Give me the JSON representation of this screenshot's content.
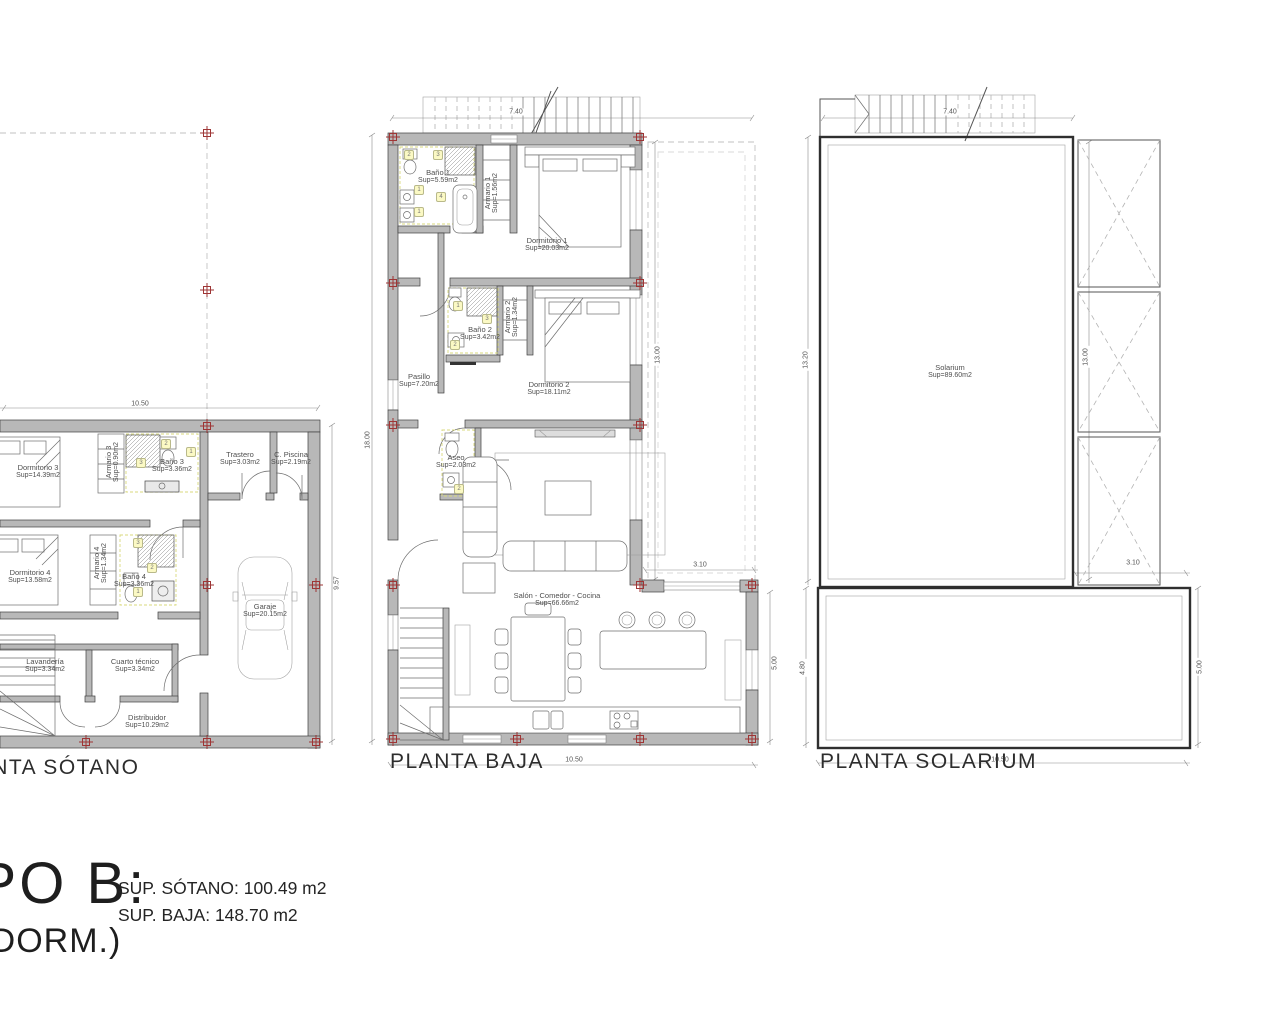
{
  "plans": {
    "sotano": {
      "title": "PLANTA SÓTANO",
      "rooms": {
        "dormitorio3": {
          "name": "Dormitorio 3",
          "area": "Sup=14.39m2"
        },
        "armario3": {
          "name": "Armario 3",
          "area": "Sup=0.90m2"
        },
        "bano3": {
          "name": "Baño 3",
          "area": "Sup=3.36m2"
        },
        "trastero": {
          "name": "Trastero",
          "area": "Sup=3.03m2"
        },
        "cpiscina": {
          "name": "C. Piscina",
          "area": "Sup=2.19m2"
        },
        "dormitorio4": {
          "name": "Dormitorio 4",
          "area": "Sup=13.58m2"
        },
        "armario4": {
          "name": "Armario 4",
          "area": "Sup=1.34m2"
        },
        "bano4": {
          "name": "Baño 4",
          "area": "Sup=3.36m2"
        },
        "garaje": {
          "name": "Garaje",
          "area": "Sup=20.15m2"
        },
        "lavanderia": {
          "name": "Lavandería",
          "area": "Sup=3.34m2"
        },
        "cuartotecnico": {
          "name": "Cuarto técnico",
          "area": "Sup=3.34m2"
        },
        "distribuidor": {
          "name": "Distribuidor",
          "area": "Sup=10.29m2"
        }
      },
      "dims": {
        "width_top": "10.50",
        "height_right": "9.57"
      },
      "badges": {
        "bano3": [
          "2",
          "1",
          "3"
        ],
        "bano4": [
          "3",
          "2",
          "1"
        ]
      }
    },
    "baja": {
      "title": "PLANTA BAJA",
      "rooms": {
        "bano1": {
          "name": "Baño 1",
          "area": "Sup=5.59m2"
        },
        "armario1": {
          "name": "Armario 1",
          "area": "Sup=1.56m2"
        },
        "dormitorio1": {
          "name": "Dormitorio 1",
          "area": "Sup=20.03m2"
        },
        "bano2": {
          "name": "Baño 2",
          "area": "Sup=3.42m2"
        },
        "armario2": {
          "name": "Armario 2",
          "area": "Sup=1.34m2"
        },
        "dormitorio2": {
          "name": "Dormitorio 2",
          "area": "Sup=18.11m2"
        },
        "pasillo": {
          "name": "Pasillo",
          "area": "Sup=7.20m2"
        },
        "aseo": {
          "name": "Aseo",
          "area": "Sup=2.03m2"
        },
        "salon": {
          "name": "Salón - Comedor - Cocina",
          "area": "Sup=66.66m2"
        }
      },
      "dims": {
        "width_top": "7.40",
        "height_left": "18.00",
        "height_right": "13.00",
        "wing_width": "3.10",
        "wing_height": "5.00",
        "width_bottom": "10.50"
      },
      "badges": {
        "bano1": [
          "2",
          "3",
          "1",
          "4",
          "1"
        ],
        "bano2": [
          "1",
          "3",
          "2"
        ],
        "aseo": [
          "2"
        ]
      }
    },
    "solarium": {
      "title": "PLANTA SOLARIUM",
      "rooms": {
        "solarium": {
          "name": "Solarium",
          "area": "Sup=89.60m2"
        }
      },
      "dims": {
        "width_top": "7.40",
        "height_left": "13.20",
        "height_inner": "13.00",
        "terrace_width": "3.10",
        "terrace_height_left": "4.80",
        "terrace_height_right": "5.00",
        "width_bottom": "10.50"
      }
    }
  },
  "summary": {
    "type_label": "TIPO B:",
    "dorm_label": "(4 DORM.)",
    "sup_sotano": "SUP. SÓTANO: 100.49 m2",
    "sup_baja": "SUP. BAJA: 148.70 m2"
  }
}
